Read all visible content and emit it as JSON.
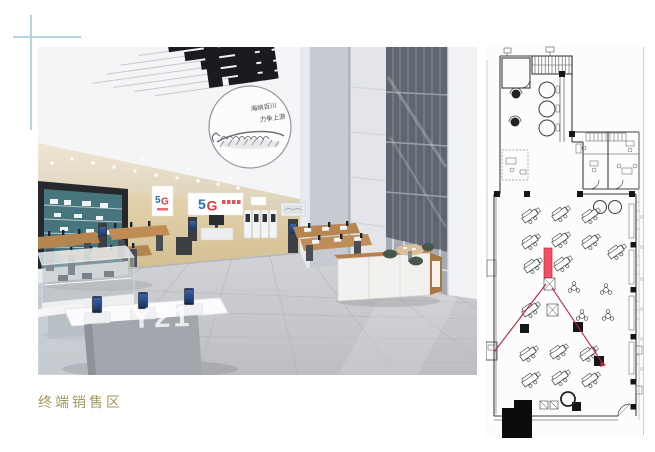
{
  "slide": {
    "caption": "终端销售区",
    "colors": {
      "caption": "#a2985e",
      "accent_line": "#b7d5e1",
      "divider": "#c9cccf"
    }
  },
  "photo": {
    "mural": {
      "line1": "海纳百川",
      "line2": "力争上游"
    },
    "logo": {
      "first": "5",
      "second": "G",
      "blue": "#1e6fba",
      "red": "#df3a40"
    },
    "watermark": "Y21",
    "wall_tan": "#d9c69d",
    "shelf_teal": "#47757d"
  },
  "floor_plan": {
    "highlight_color": "#f25062",
    "view_line_color": "#bf2336",
    "line_color": "#3c3e40"
  }
}
